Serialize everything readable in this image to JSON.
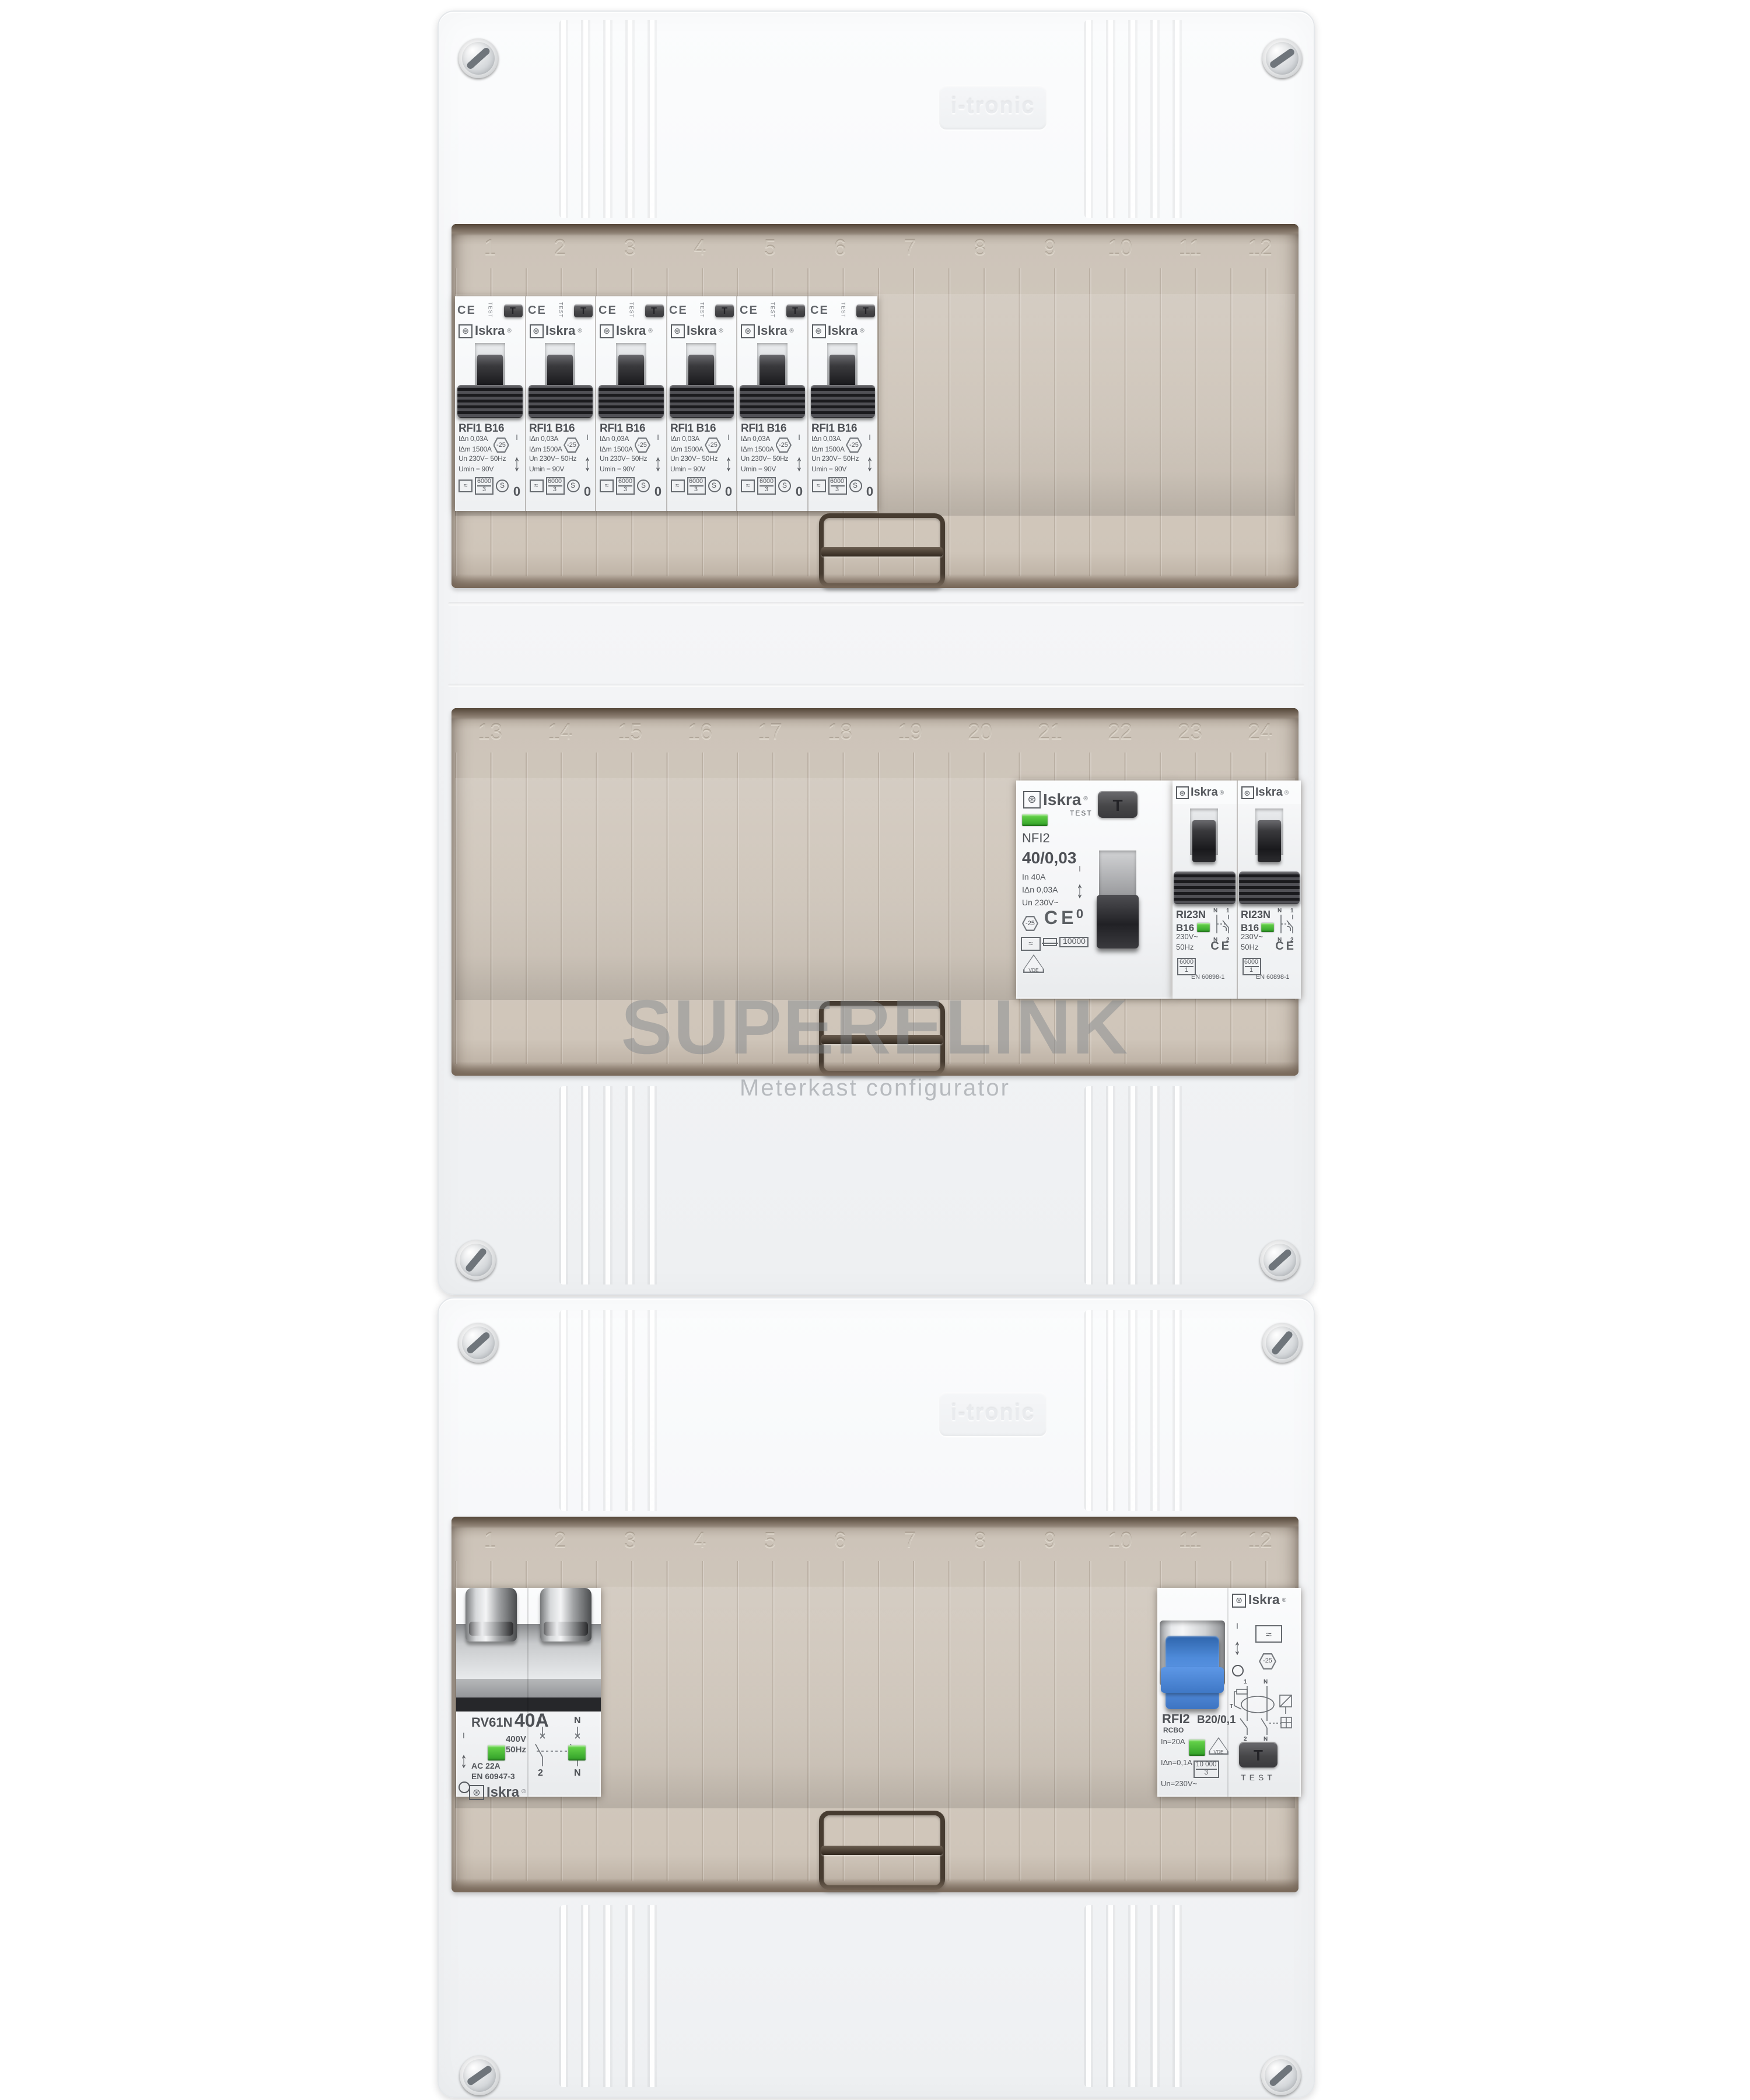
{
  "watermark": {
    "title": "SUPERELINK",
    "subtitle": "Meterkast configurator"
  },
  "enclosure": {
    "emboss_brand": "i-tronic"
  },
  "icons": {
    "updown_arrow": "↕"
  },
  "colors": {
    "indicator_green": "#38b12e",
    "toggle_blue": "#4a86d8",
    "cover_tan": "#cfc6bb",
    "device_white": "#f4f5f6",
    "handle_black": "#222226",
    "watermark_gray": "#8a9096"
  },
  "covers": {
    "row1_numbers": [
      "1",
      "2",
      "3",
      "4",
      "5",
      "6",
      "7",
      "8",
      "9",
      "10",
      "11",
      "12"
    ],
    "row2_numbers": [
      "13",
      "14",
      "15",
      "16",
      "17",
      "18",
      "19",
      "20",
      "21",
      "22",
      "23",
      "24"
    ],
    "row3_numbers": [
      "1",
      "2",
      "3",
      "4",
      "5",
      "6",
      "7",
      "8",
      "9",
      "10",
      "11",
      "12"
    ]
  },
  "devices": {
    "rfi1": {
      "slots": [
        "1",
        "2",
        "3",
        "4",
        "5",
        "6"
      ],
      "ce_mark": "CE",
      "test_label": "TEST",
      "test_button": "T",
      "brand": "Iskra",
      "brand_reg": "®",
      "brand_emblem": "⊛",
      "model": "RFI1 B16",
      "spec1": "IΔn 0,03A",
      "spec2": "IΔm 1500A",
      "spec3": "Un 230V~ 50Hz",
      "spec4": "Umin = 90V",
      "surge_icon": "≈",
      "breaking_capacity": "6000",
      "energy_class": "3",
      "selectivity": "S",
      "temp_rating": "-25",
      "on_symbol": "I",
      "off_symbol": "0"
    },
    "nfi2": {
      "brand": "Iskra",
      "brand_reg": "®",
      "brand_emblem": "⊛",
      "test_label": "TEST",
      "test_button": "T",
      "model": "NFI2",
      "rating": "40/0,03",
      "spec1": "In 40A",
      "spec2": "IΔn 0,03A",
      "spec3": "Un 230V~",
      "temp_rating": "-25",
      "ce_mark": "CE",
      "surge_icon": "≈",
      "breaking_capacity": "10000",
      "vde_label": "VDE",
      "on_symbol": "I",
      "off_symbol": "0"
    },
    "ri23n": {
      "slots": [
        "1",
        "2"
      ],
      "brand": "Iskra",
      "brand_reg": "®",
      "brand_emblem": "⊛",
      "model": "RI23N",
      "rating": "B16",
      "spec1": "230V~",
      "spec2": "50Hz",
      "breaking_capacity": "6000",
      "energy_class": "1",
      "standard": "EN 60898-1",
      "ce_mark": "CE",
      "term_n": "N",
      "term_top": "1",
      "term_bottom": "2"
    },
    "rv61n": {
      "model": "RV61N",
      "rating": "40A",
      "voltage": "400V",
      "frequency": "50Hz",
      "utilization": "AC 22A",
      "standard": "EN 60947-3",
      "brand": "Iskra",
      "brand_reg": "®",
      "brand_emblem": "⊛",
      "on_symbol": "I",
      "term_top_left": "1",
      "term_top_right": "N",
      "term_bottom_left": "2",
      "term_bottom_right": "N"
    },
    "rfi2": {
      "brand": "Iskra",
      "brand_reg": "®",
      "brand_emblem": "⊛",
      "model": "RFI2",
      "type": "RCBO",
      "rating": "B20/0,1",
      "spec1": "In=20A",
      "spec2": "IΔn=0,1A",
      "spec3": "Un=230V~",
      "breaking_capacity": "10 000",
      "energy_class": "3",
      "vde_label": "VDE",
      "surge_icon": "≈",
      "temp_rating": "-25",
      "on_symbol": "I",
      "term_top_left": "1",
      "term_top_right": "N",
      "term_bottom_left": "2",
      "term_bottom_right": "N",
      "diag_t": "T",
      "test_label": "TEST",
      "test_button": "T"
    }
  }
}
